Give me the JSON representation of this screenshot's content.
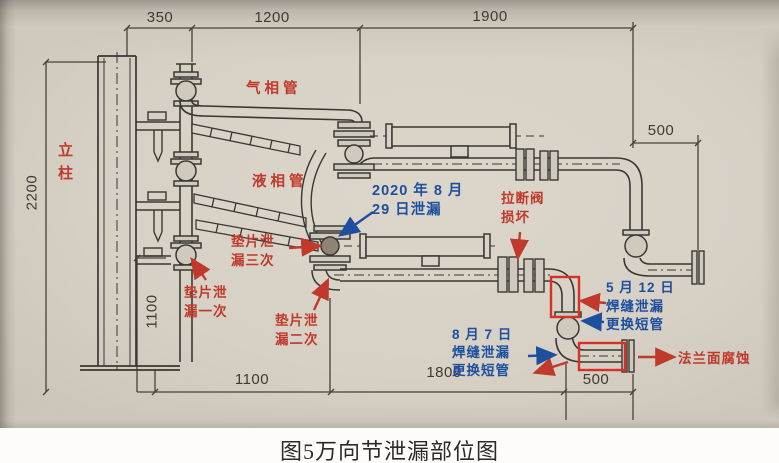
{
  "figure": {
    "caption": "图5万向节泄漏部位图"
  },
  "colors": {
    "annotation_red": "#c0392b",
    "annotation_blue": "#1e4f9e",
    "highlight_red": "#d93025",
    "drawing_line": "#3a3733",
    "photo_background": "#d6d0c5"
  },
  "labels": {
    "column": "立柱",
    "gas_pipe": "气相管",
    "liquid_pipe": "液相管"
  },
  "annotations": {
    "leak_2020": {
      "line1": "2020 年 8 月",
      "line2": "29 日泄漏"
    },
    "gasket_leak_once": {
      "line1": "垫片泄",
      "line2": "漏一次"
    },
    "gasket_leak_twice": {
      "line1": "垫片泄",
      "line2": "漏二次"
    },
    "gasket_leak_thrice": {
      "line1": "垫片泄",
      "line2": "漏三次"
    },
    "breakaway_valve": {
      "line1": "拉断阀",
      "line2": "损坏"
    },
    "weld_leak_may12": {
      "line1": "5 月 12 日",
      "line2": "焊缝泄漏",
      "line3": "更换短管"
    },
    "weld_leak_aug7": {
      "line1": "8 月 7 日",
      "line2": "焊缝泄漏",
      "line3": "更换短管"
    },
    "flange_corrosion": "法兰面腐蚀"
  },
  "dimensions": {
    "top": [
      "350",
      "1200",
      "1900"
    ],
    "right_offset": "500",
    "column_height": "2200",
    "lower_height": "1100",
    "bottom": [
      "1100",
      "1800",
      "500"
    ]
  }
}
